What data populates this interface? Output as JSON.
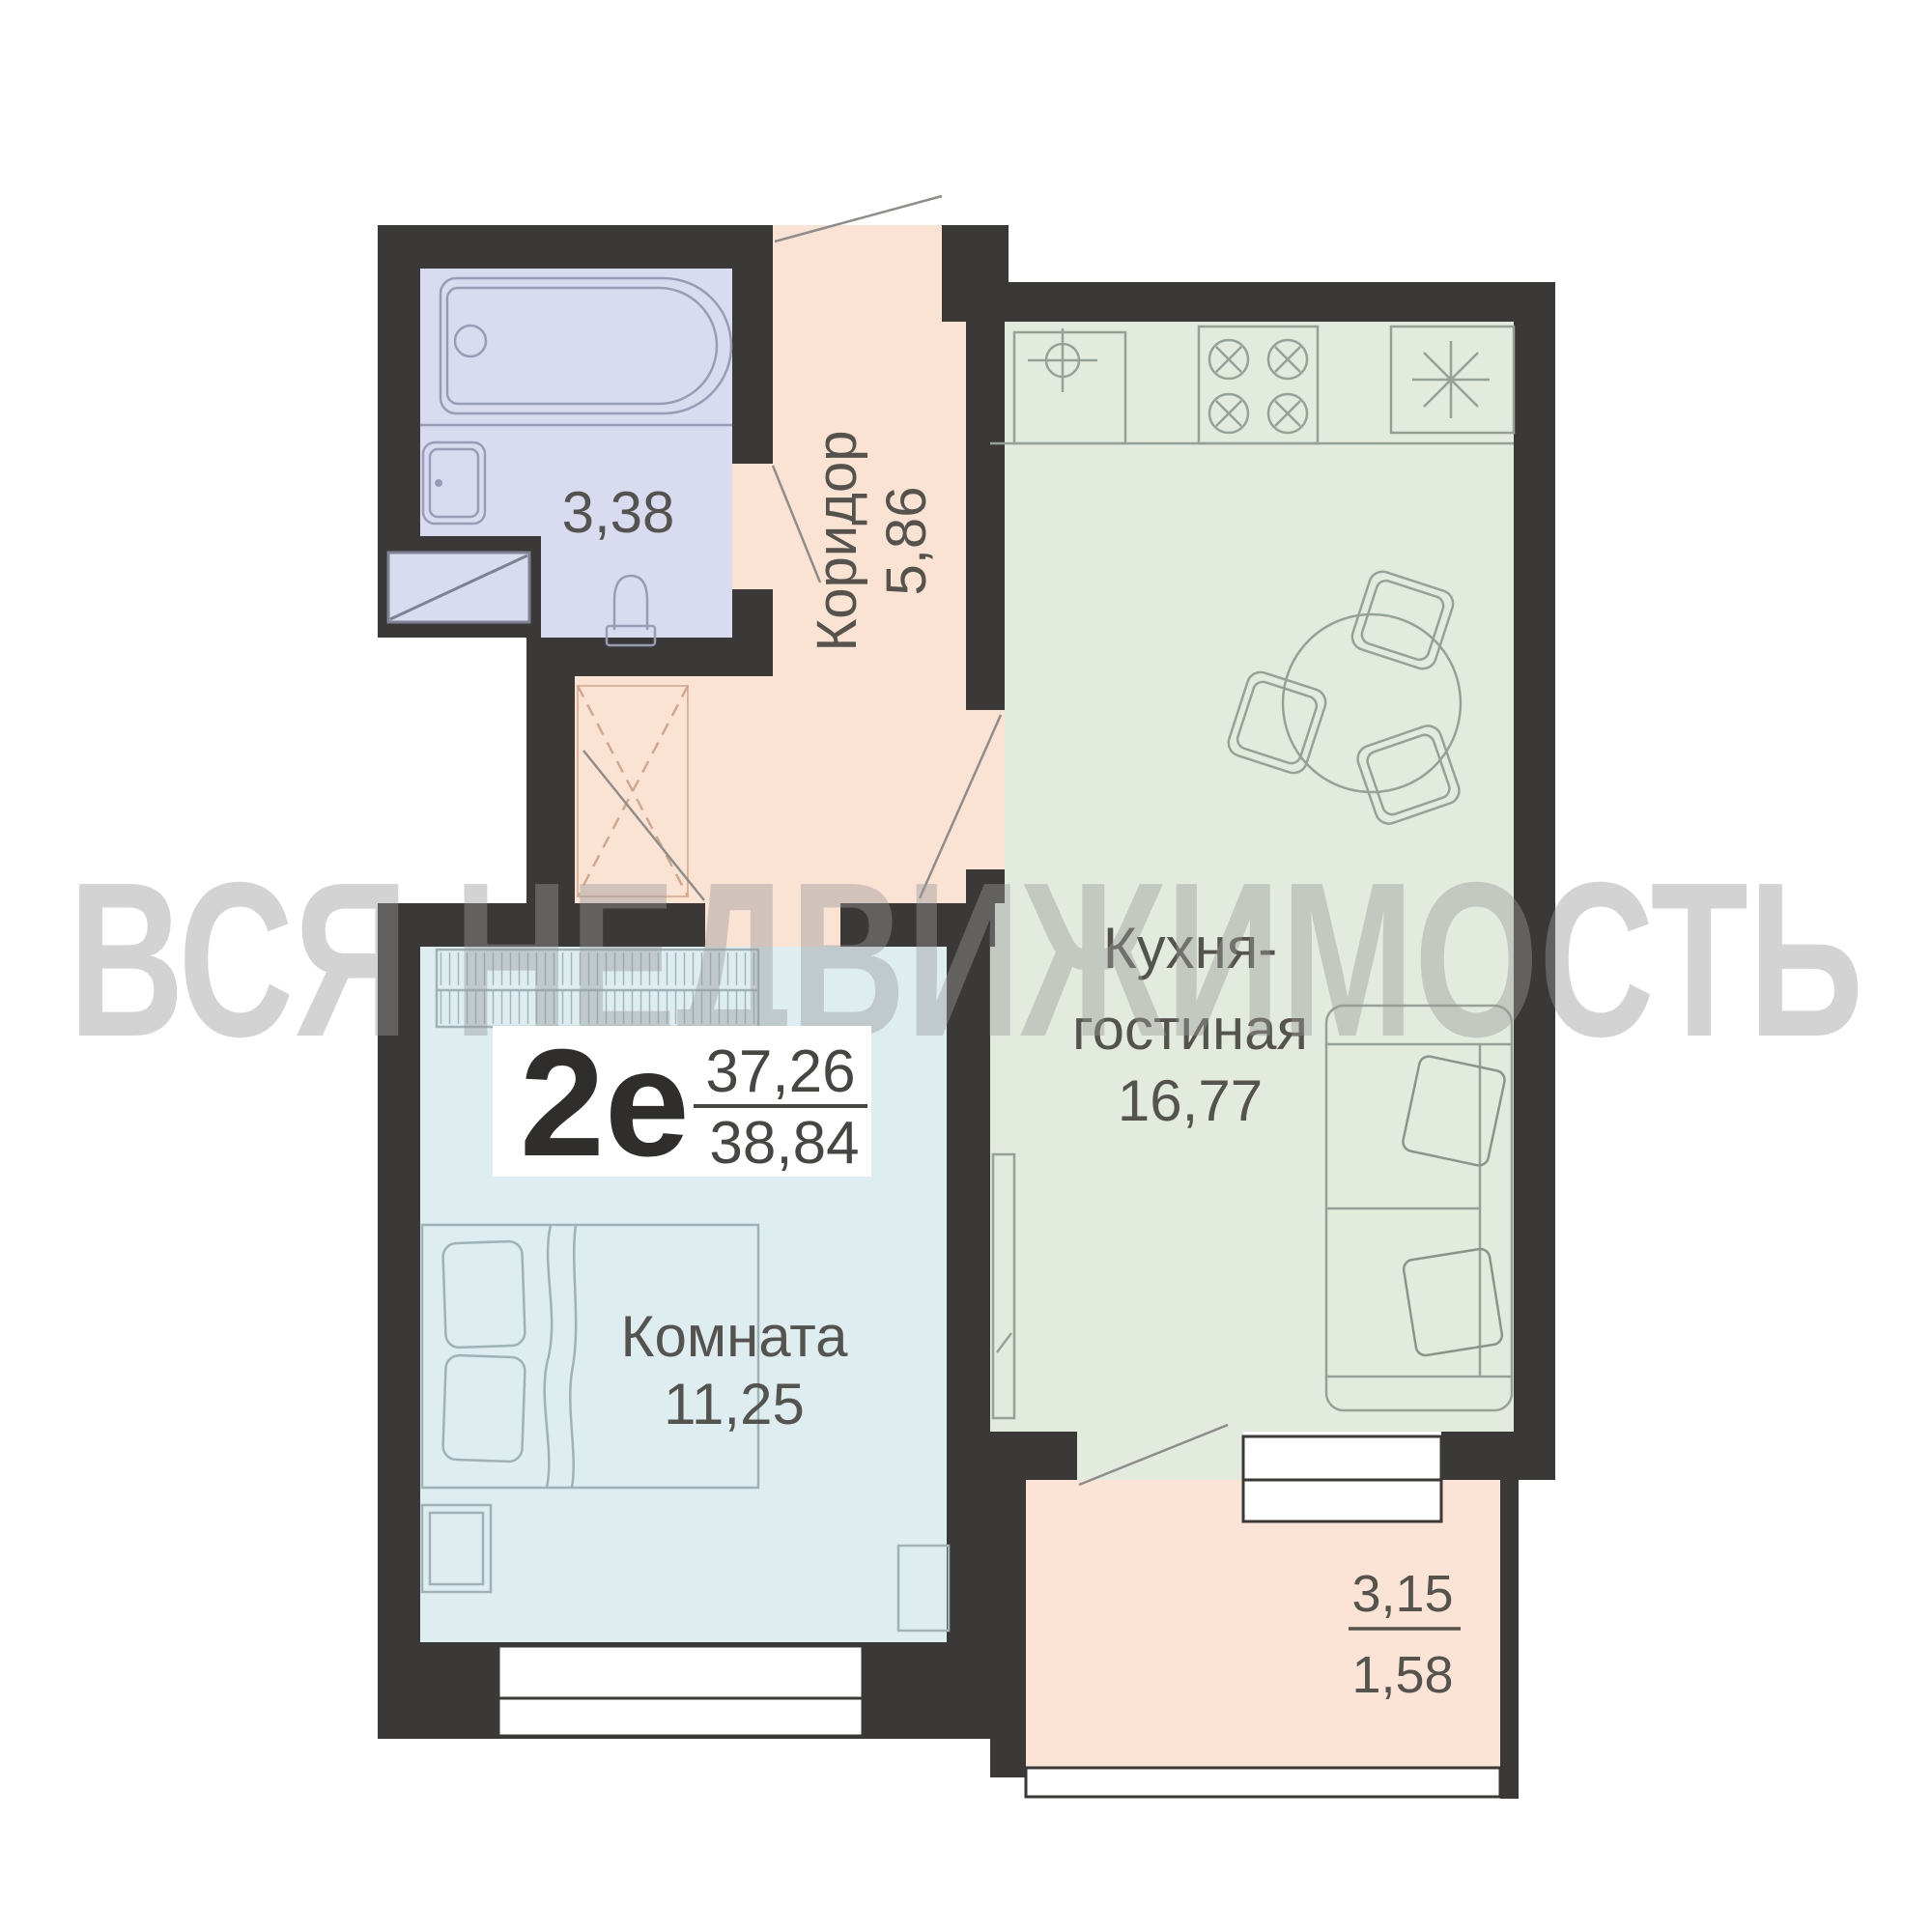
{
  "watermark": {
    "text": "ВСЯ НЕДВИЖИМОСТЬ"
  },
  "badge": {
    "type": "2е",
    "area_living": "37,26",
    "area_total": "38,84"
  },
  "rooms": {
    "bathroom": {
      "area": "3,38"
    },
    "corridor": {
      "name": "Коридор",
      "area": "5,86"
    },
    "kitchen": {
      "name_line1": "Кухня-",
      "name_line2": "гостиная",
      "area": "16,77"
    },
    "room": {
      "name": "Комната",
      "area": "11,25"
    },
    "balcony": {
      "area_full": "3,15",
      "area_reduced": "1,58"
    }
  },
  "colors": {
    "wall": "#3b3937",
    "bathroom_floor": "#d9dcf1",
    "corridor_floor": "#fbe3d4",
    "kitchen_floor": "#e3ebde",
    "room_floor": "#ddedf0",
    "balcony_floor": "#fbe4d6",
    "label_text": "#55534e",
    "badge_text": "#2f2e2c",
    "badge_fraction": "#474643"
  }
}
